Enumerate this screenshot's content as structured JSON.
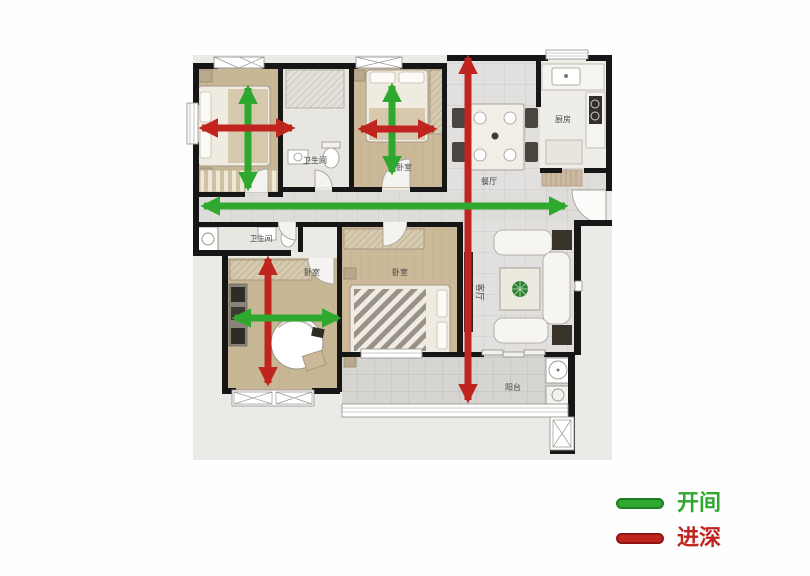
{
  "colors": {
    "bay": "#2EA82E",
    "depth": "#C0241E",
    "wall": "#161616",
    "label": "#474747"
  },
  "legend": {
    "items": [
      {
        "id": "bay",
        "label": "开间",
        "color": "#2EA82E",
        "edge": "#1E7E24"
      },
      {
        "id": "depth",
        "label": "进深",
        "color": "#C0241E",
        "edge": "#8E1612"
      }
    ]
  },
  "plan": {
    "rooms": [
      {
        "id": "bathroom-north",
        "label": "卫生间",
        "x": 315,
        "y": 163,
        "size": 8
      },
      {
        "id": "bedroom-north",
        "label": "卧室",
        "x": 404,
        "y": 170,
        "size": 8
      },
      {
        "id": "dining-room",
        "label": "餐厅",
        "x": 489,
        "y": 184,
        "size": 8
      },
      {
        "id": "kitchen",
        "label": "厨房",
        "x": 563,
        "y": 122,
        "size": 8
      },
      {
        "id": "bathroom-south",
        "label": "卫生间",
        "x": 261,
        "y": 241,
        "size": 7.5
      },
      {
        "id": "bedroom-southwest",
        "label": "卧室",
        "x": 312,
        "y": 275,
        "size": 8
      },
      {
        "id": "bedroom-master",
        "label": "卧室",
        "x": 400,
        "y": 275,
        "size": 8
      },
      {
        "id": "living-room",
        "label": "客厅",
        "x": 477,
        "y": 292,
        "size": 8.5,
        "rotate": 90
      },
      {
        "id": "balcony",
        "label": "阳台",
        "x": 513,
        "y": 390,
        "size": 8
      }
    ],
    "arrows": [
      {
        "id": "bay-bedroom-nw",
        "dim": "开间",
        "color": "bay",
        "x1": 248,
        "y1": 88,
        "x2": 248,
        "y2": 188
      },
      {
        "id": "depth-bedroom-nw",
        "dim": "进深",
        "color": "depth",
        "x1": 202,
        "y1": 128,
        "x2": 292,
        "y2": 128
      },
      {
        "id": "bay-bedroom-north",
        "dim": "开间",
        "color": "bay",
        "x1": 392,
        "y1": 86,
        "x2": 392,
        "y2": 172
      },
      {
        "id": "depth-bedroom-north",
        "dim": "进深",
        "color": "depth",
        "x1": 361,
        "y1": 129,
        "x2": 434,
        "y2": 129
      },
      {
        "id": "depth-overall",
        "dim": "进深",
        "color": "depth",
        "x1": 468,
        "y1": 58,
        "x2": 468,
        "y2": 400
      },
      {
        "id": "bay-overall",
        "dim": "开间",
        "color": "bay",
        "x1": 204,
        "y1": 206,
        "x2": 565,
        "y2": 206
      },
      {
        "id": "depth-bedroom-sw",
        "dim": "进深",
        "color": "depth",
        "x1": 268,
        "y1": 259,
        "x2": 268,
        "y2": 383
      },
      {
        "id": "bay-bedroom-sw",
        "dim": "开间",
        "color": "bay",
        "x1": 235,
        "y1": 318,
        "x2": 338,
        "y2": 318
      }
    ]
  }
}
